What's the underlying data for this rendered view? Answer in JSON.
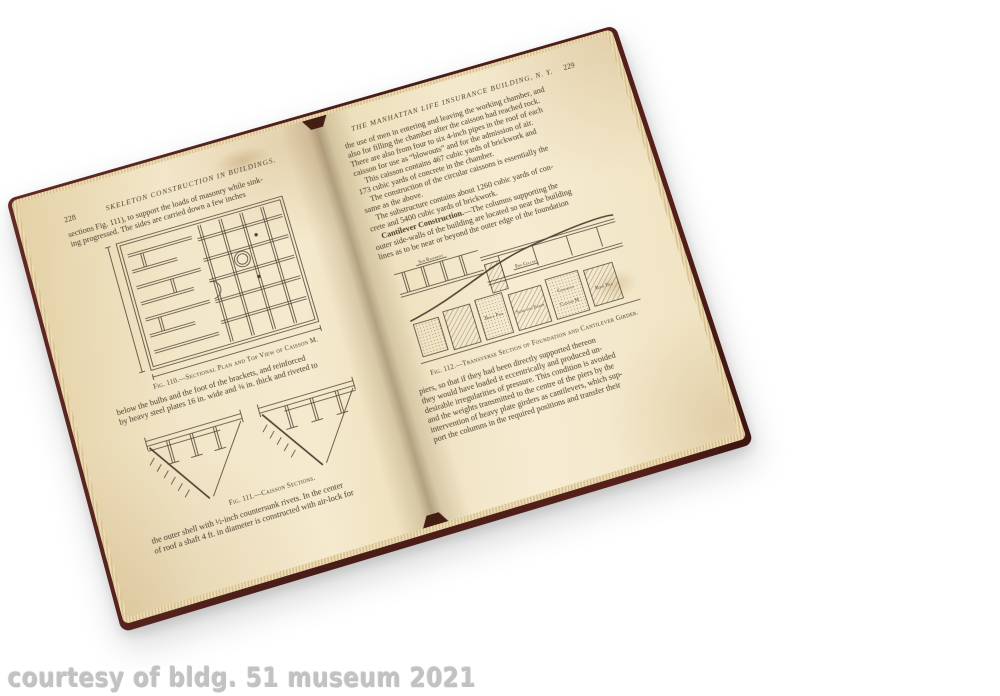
{
  "watermark": {
    "text": "courtesy of bldg. 51 museum 2021"
  },
  "colors": {
    "background": "#ffffff",
    "cover_maroon": "#4f1f1a",
    "page_cream": "#f2e6c8",
    "ink": "#463b2b",
    "watermark_gray": "#c2c2c2"
  },
  "left_page": {
    "page_number": "228",
    "running_header": "SKELETON CONSTRUCTION IN BUILDINGS.",
    "para1_lines": [
      "sections Fig. 111), to support the loads of masonry while sink-",
      "ing progressed.  The sides are carried down a few inches"
    ],
    "fig110_caption": "Fig. 110.—Sectional Plan and Top View of Caisson M.",
    "para2_lines": [
      "below the bulbs and the foot of the brackets, and reinforced",
      "by heavy steel plates 16 in. wide and ⅜ in. thick and riveted to"
    ],
    "fig111_caption": "Fig. 111.—Caisson Sections.",
    "para3_lines": [
      "the outer shell with ½-inch countersunk rivets.  In the center",
      "of roof a shaft 4 ft. in diameter is constructed with air-lock for"
    ]
  },
  "right_page": {
    "running_header": "THE MANHATTAN LIFE INSURANCE BUILDING, N. Y.",
    "page_number": "229",
    "para1_lines": [
      "the use of men in entering and leaving the working chamber, and",
      "also for filling the chamber after the caisson had reached rock.",
      "There are also from four to six 4-inch pipes in the roof of each",
      "caisson for use as “blowouts” and for the admission of air."
    ],
    "para2_lines": [
      "This caisson contains 467 cubic yards of brickwork and",
      "173 cubic yards of concrete in the chamber."
    ],
    "para3_lines": [
      "The construction of the circular caissons is essentially the",
      "same as the above."
    ],
    "para4_lines": [
      "The substructure contains about 1260 cubic yards of con-",
      "crete and 5400 cubic yards of brickwork."
    ],
    "para5_lead": "Cantilever Construction.",
    "para5_rest": "—The columns supporting the",
    "para5_lines": [
      "outer side-walls of the building are located so near the building",
      "lines as to be near or beyond the outer edge of the foundation"
    ],
    "fig112_caption": "Fig. 112.—Transverse Section of Foundation and Cantilever Girder.",
    "fig112_labels": {
      "sub_basement": "Sub Basement",
      "pipe_cellar": "Pipe Cellar",
      "brick_pier": "Brick Pier",
      "sand_and_earth": "Sand and Earth",
      "concrete": "Concrete",
      "caisson_m": "Caisson M",
      "rock_fill": "Rock Fill"
    },
    "para6_lines": [
      "piers, so that if they had been directly supported thereon",
      "they would have loaded it eccentrically and produced un-",
      "desirable irregularities of pressure.  This condition is avoided",
      "and the weights transmitted to the centre of the piers by the",
      "intervention of heavy plate girders as cantilevers, which sup-",
      "port the columns in the required positions and transfer their"
    ]
  }
}
